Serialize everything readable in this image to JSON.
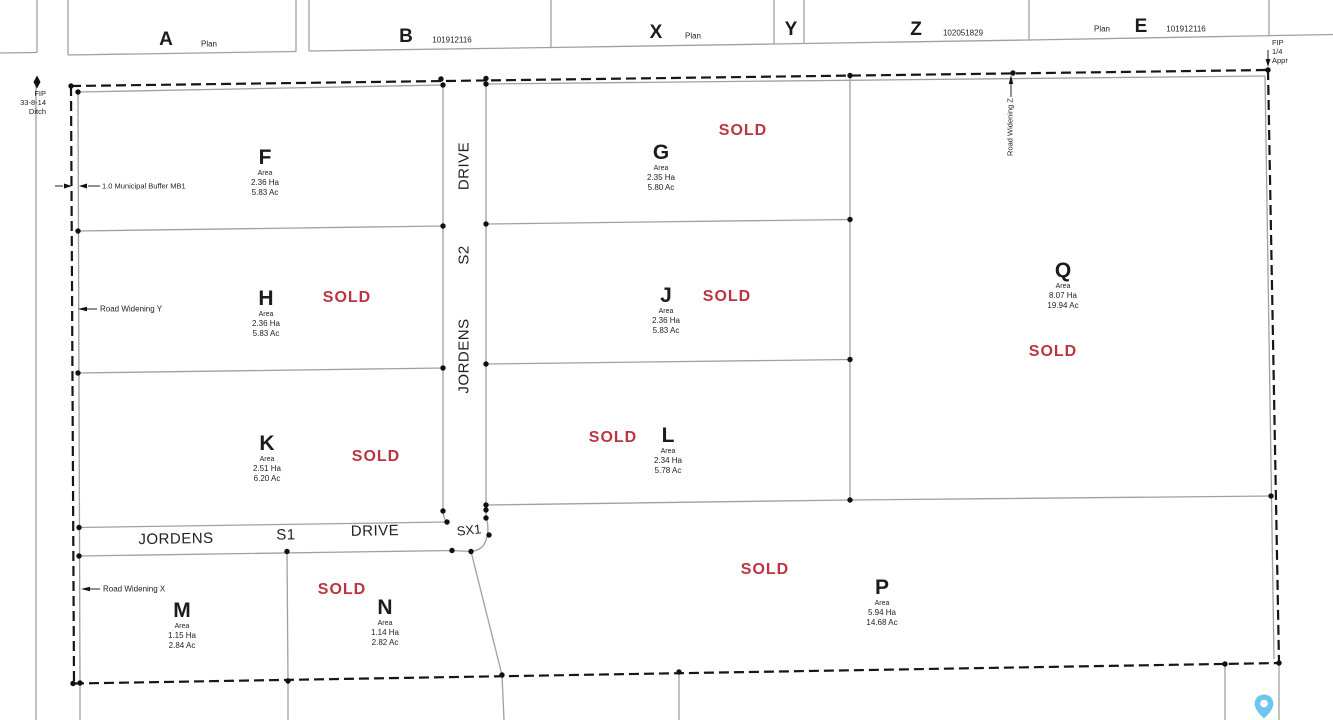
{
  "colors": {
    "sold": "#bb3540",
    "boundary": "#161616",
    "lot_line": "#a0a0a0",
    "pin": "#6ec6ef"
  },
  "top_strip": {
    "parcels": [
      {
        "label": "A",
        "note": "Plan"
      },
      {
        "label": "B",
        "note": "101912116"
      },
      {
        "label": "X",
        "note": "Plan"
      },
      {
        "label": "Y"
      },
      {
        "label": "Z",
        "note": "102051829"
      },
      {
        "label": "E",
        "prefix": "Plan",
        "note": "101912116"
      }
    ]
  },
  "annotations": {
    "fip_ditch": {
      "line1": "FIP",
      "line2": "33-8-14",
      "line3": "Ditch"
    },
    "fip_appr": {
      "line1": "FIP",
      "line2": "1/4",
      "line3": "Appr"
    },
    "municipal_buffer": "1.0 Municipal Buffer MB1",
    "road_widening_y": "Road Widening Y",
    "road_widening_x": "Road Widening X",
    "road_widening_z": "Road Widening Z"
  },
  "streets": {
    "vertical": {
      "word1": "DRIVE",
      "word2": "S2",
      "word3": "JORDENS"
    },
    "horizontal": {
      "word1": "JORDENS",
      "word2": "S1",
      "word3": "DRIVE"
    },
    "junction": "SX1"
  },
  "lots": {
    "F": {
      "name": "F",
      "area_label": "Area",
      "ha": "2.36 Ha",
      "ac": "5.83 Ac"
    },
    "G": {
      "name": "G",
      "area_label": "Area",
      "ha": "2.35 Ha",
      "ac": "5.80 Ac",
      "sold": "SOLD"
    },
    "H": {
      "name": "H",
      "area_label": "Area",
      "ha": "2.36 Ha",
      "ac": "5.83 Ac",
      "sold": "SOLD"
    },
    "J": {
      "name": "J",
      "area_label": "Area",
      "ha": "2.36 Ha",
      "ac": "5.83 Ac",
      "sold": "SOLD"
    },
    "K": {
      "name": "K",
      "area_label": "Area",
      "ha": "2.51 Ha",
      "ac": "6.20 Ac",
      "sold": "SOLD"
    },
    "L": {
      "name": "L",
      "area_label": "Area",
      "ha": "2.34 Ha",
      "ac": "5.78 Ac",
      "sold": "SOLD"
    },
    "Q": {
      "name": "Q",
      "area_label": "Area",
      "ha": "8.07 Ha",
      "ac": "19.94 Ac",
      "sold": "SOLD"
    },
    "M": {
      "name": "M",
      "area_label": "Area",
      "ha": "1.15 Ha",
      "ac": "2.84 Ac"
    },
    "N": {
      "name": "N",
      "area_label": "Area",
      "ha": "1.14 Ha",
      "ac": "2.82 Ac",
      "sold": "SOLD"
    },
    "P": {
      "name": "P",
      "area_label": "Area",
      "ha": "5.94 Ha",
      "ac": "14.68 Ac",
      "sold": "SOLD"
    }
  }
}
